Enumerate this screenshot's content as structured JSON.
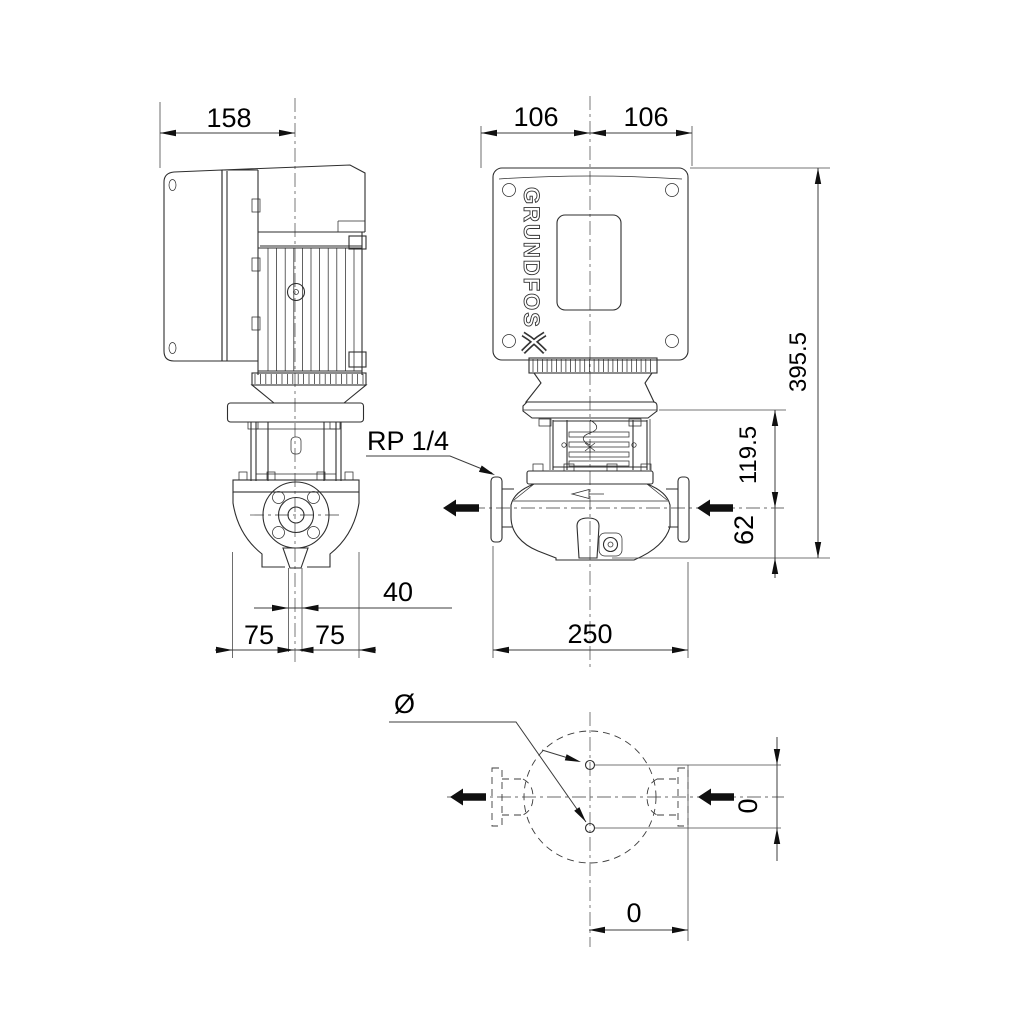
{
  "drawing": {
    "brand": "GRUNDFOS",
    "dims": {
      "d158": "158",
      "d106l": "106",
      "d106r": "106",
      "d395": "395.5",
      "d119": "119.5",
      "d62": "62",
      "rp": "RP 1/4",
      "d40": "40",
      "d75l": "75",
      "d75r": "75",
      "d250": "250",
      "dia": "Ø",
      "d0v": "0",
      "d0h": "0"
    },
    "colors": {
      "line": "#2e2e2e",
      "dim_text": "#000000",
      "background": "#ffffff"
    }
  }
}
